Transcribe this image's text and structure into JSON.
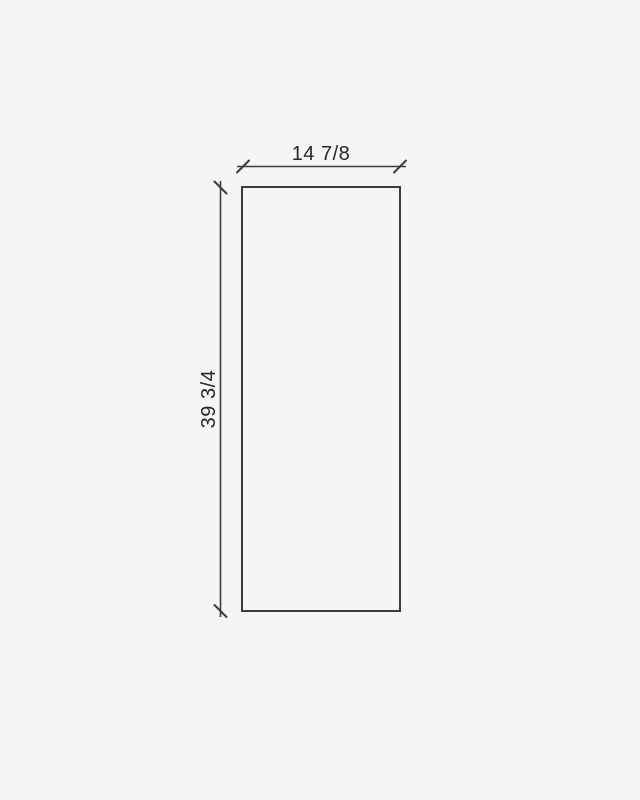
{
  "drawing": {
    "width_dimension": {
      "label": "14 7/8"
    },
    "height_dimension": {
      "label": "39 3/4"
    }
  },
  "colors": {
    "background": "#f5f5f6",
    "line": "#3c3c3c",
    "text": "#262626"
  }
}
